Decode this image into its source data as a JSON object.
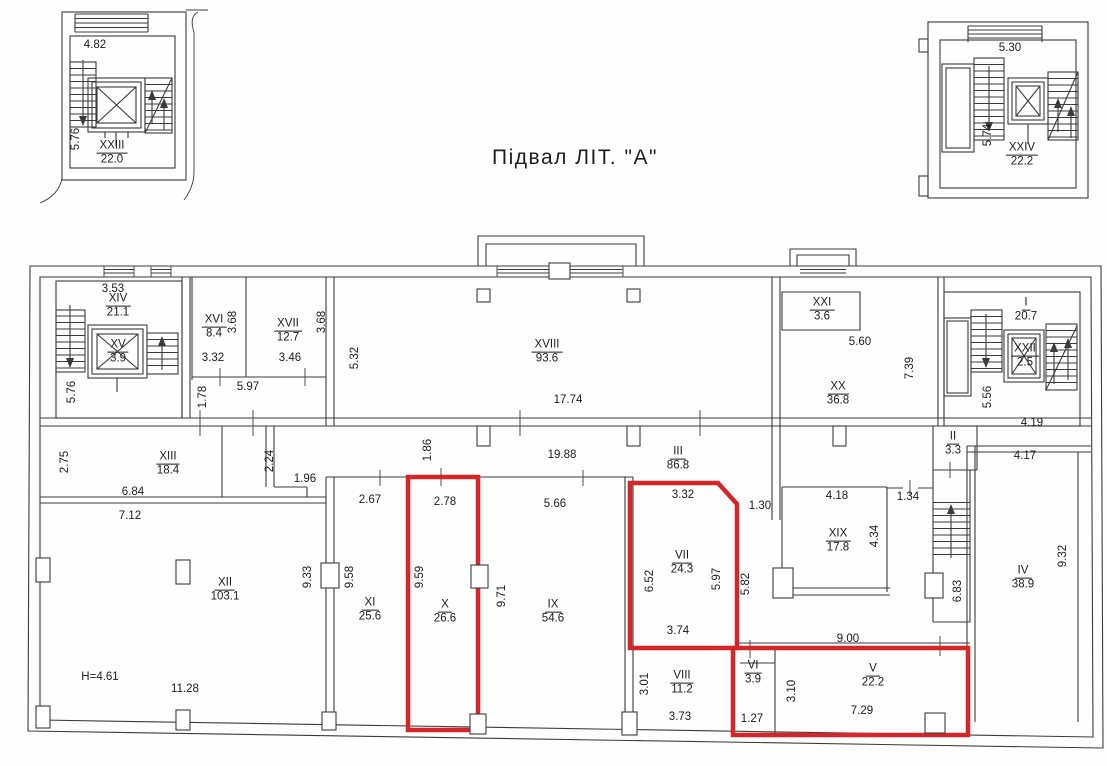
{
  "title": {
    "text": "Підвал  ЛІТ. \"А\"",
    "x": 575,
    "y": 158
  },
  "colors": {
    "wall": "#3b3b3b",
    "highlight_red": "#d42626",
    "paper": "#fefefe",
    "text": "#1b1b1b"
  },
  "legend": {
    "drawing_type": "basement-floor-plan"
  },
  "rooms": [
    {
      "numeral": "XXIII",
      "area": "22.0",
      "x": 112,
      "y": 153,
      "group": "detached-left"
    },
    {
      "numeral": "XXIV",
      "area": "22.2",
      "x": 1022,
      "y": 155,
      "group": "detached-right"
    },
    {
      "numeral": "XIV",
      "area": "21.1",
      "x": 118,
      "y": 306,
      "group": "main"
    },
    {
      "numeral": "XV",
      "area": "3.9",
      "x": 118,
      "y": 352,
      "group": "main"
    },
    {
      "numeral": "XVI",
      "area": "8.4",
      "x": 214,
      "y": 327,
      "group": "main"
    },
    {
      "numeral": "XVII",
      "area": "12.7",
      "x": 288,
      "y": 331,
      "group": "main"
    },
    {
      "numeral": "XVIII",
      "area": "93.6",
      "x": 547,
      "y": 352,
      "group": "main"
    },
    {
      "numeral": "XXI",
      "area": "3.6",
      "x": 822,
      "y": 310,
      "group": "main"
    },
    {
      "numeral": "XX",
      "area": "36.8",
      "x": 838,
      "y": 394,
      "group": "main"
    },
    {
      "numeral": "I",
      "area": "20.7",
      "x": 1026,
      "y": 310,
      "group": "main"
    },
    {
      "numeral": "XXII",
      "area": "2.5",
      "x": 1025,
      "y": 356,
      "group": "main"
    },
    {
      "numeral": "II",
      "area": "3.3",
      "x": 953,
      "y": 444,
      "group": "main"
    },
    {
      "numeral": "XIII",
      "area": "18.4",
      "x": 168,
      "y": 464,
      "group": "main"
    },
    {
      "numeral": "III",
      "area": "86.8",
      "x": 678,
      "y": 459,
      "group": "main"
    },
    {
      "numeral": "XII",
      "area": "103.1",
      "x": 225,
      "y": 590,
      "group": "main"
    },
    {
      "numeral": "XI",
      "area": "25.6",
      "x": 370,
      "y": 610,
      "group": "main"
    },
    {
      "numeral": "X",
      "area": "26.6",
      "x": 445,
      "y": 612,
      "group": "main",
      "highlighted": true
    },
    {
      "numeral": "IX",
      "area": "54.6",
      "x": 553,
      "y": 612,
      "group": "main"
    },
    {
      "numeral": "VII",
      "area": "24.3",
      "x": 682,
      "y": 563,
      "group": "main",
      "highlighted": true
    },
    {
      "numeral": "XIX",
      "area": "17.8",
      "x": 838,
      "y": 541,
      "group": "main"
    },
    {
      "numeral": "IV",
      "area": "38.9",
      "x": 1023,
      "y": 578,
      "group": "main"
    },
    {
      "numeral": "VIII",
      "area": "11.2",
      "x": 682,
      "y": 683,
      "group": "main"
    },
    {
      "numeral": "VI",
      "area": "3.9",
      "x": 753,
      "y": 673,
      "group": "main",
      "highlighted": true
    },
    {
      "numeral": "V",
      "area": "22.2",
      "x": 873,
      "y": 676,
      "group": "main",
      "highlighted": true
    }
  ],
  "dimensions": [
    {
      "text": "4.82",
      "x": 95,
      "y": 45
    },
    {
      "text": "5.76",
      "x": 76,
      "y": 139,
      "rot": true
    },
    {
      "text": "5.30",
      "x": 1010,
      "y": 48
    },
    {
      "text": "5.74",
      "x": 988,
      "y": 135,
      "rot": true
    },
    {
      "text": "3.53",
      "x": 113,
      "y": 289
    },
    {
      "text": "5.76",
      "x": 72,
      "y": 392,
      "rot": true
    },
    {
      "text": "3.32",
      "x": 213,
      "y": 358
    },
    {
      "text": "3.68",
      "x": 233,
      "y": 322,
      "rot": true
    },
    {
      "text": "3.46",
      "x": 290,
      "y": 358
    },
    {
      "text": "3.68",
      "x": 322,
      "y": 322,
      "rot": true
    },
    {
      "text": "5.97",
      "x": 248,
      "y": 387
    },
    {
      "text": "1.78",
      "x": 203,
      "y": 397,
      "rot": true
    },
    {
      "text": "5.32",
      "x": 355,
      "y": 358,
      "rot": true
    },
    {
      "text": "17.74",
      "x": 568,
      "y": 400
    },
    {
      "text": "5.60",
      "x": 860,
      "y": 342
    },
    {
      "text": "7.39",
      "x": 910,
      "y": 368,
      "rot": true
    },
    {
      "text": "5.56",
      "x": 988,
      "y": 397,
      "rot": true
    },
    {
      "text": "4.19",
      "x": 1032,
      "y": 423
    },
    {
      "text": "2.75",
      "x": 65,
      "y": 462,
      "rot": true
    },
    {
      "text": "6.84",
      "x": 133,
      "y": 492
    },
    {
      "text": "7.12",
      "x": 130,
      "y": 516
    },
    {
      "text": "2.24",
      "x": 270,
      "y": 461,
      "rot": true
    },
    {
      "text": "1.96",
      "x": 305,
      "y": 479
    },
    {
      "text": "1.86",
      "x": 428,
      "y": 450,
      "rot": true
    },
    {
      "text": "19.88",
      "x": 562,
      "y": 455
    },
    {
      "text": "2.67",
      "x": 370,
      "y": 500
    },
    {
      "text": "2.78",
      "x": 445,
      "y": 502
    },
    {
      "text": "5.66",
      "x": 555,
      "y": 504
    },
    {
      "text": "3.32",
      "x": 683,
      "y": 495
    },
    {
      "text": "1.30",
      "x": 760,
      "y": 506
    },
    {
      "text": "4.18",
      "x": 837,
      "y": 496
    },
    {
      "text": "1.34",
      "x": 908,
      "y": 497
    },
    {
      "text": "4.17",
      "x": 1025,
      "y": 456
    },
    {
      "text": "9.33",
      "x": 308,
      "y": 577,
      "rot": true
    },
    {
      "text": "9.58",
      "x": 350,
      "y": 577,
      "rot": true
    },
    {
      "text": "9.59",
      "x": 420,
      "y": 577,
      "rot": true
    },
    {
      "text": "9.71",
      "x": 502,
      "y": 596,
      "rot": true
    },
    {
      "text": "6.52",
      "x": 650,
      "y": 581,
      "rot": true
    },
    {
      "text": "5.97",
      "x": 717,
      "y": 579,
      "rot": true
    },
    {
      "text": "5.82",
      "x": 746,
      "y": 584,
      "rot": true
    },
    {
      "text": "4.34",
      "x": 875,
      "y": 536,
      "rot": true
    },
    {
      "text": "6.83",
      "x": 958,
      "y": 591,
      "rot": true
    },
    {
      "text": "9.32",
      "x": 1063,
      "y": 556,
      "rot": true
    },
    {
      "text": "H=4.61",
      "x": 100,
      "y": 677
    },
    {
      "text": "11.28",
      "x": 185,
      "y": 689
    },
    {
      "text": "3.74",
      "x": 678,
      "y": 631
    },
    {
      "text": "9.00",
      "x": 848,
      "y": 639
    },
    {
      "text": "3.01",
      "x": 645,
      "y": 684,
      "rot": true
    },
    {
      "text": "3.73",
      "x": 680,
      "y": 717
    },
    {
      "text": "1.27",
      "x": 752,
      "y": 719
    },
    {
      "text": "3.10",
      "x": 792,
      "y": 691,
      "rot": true
    },
    {
      "text": "7.29",
      "x": 862,
      "y": 711
    }
  ]
}
